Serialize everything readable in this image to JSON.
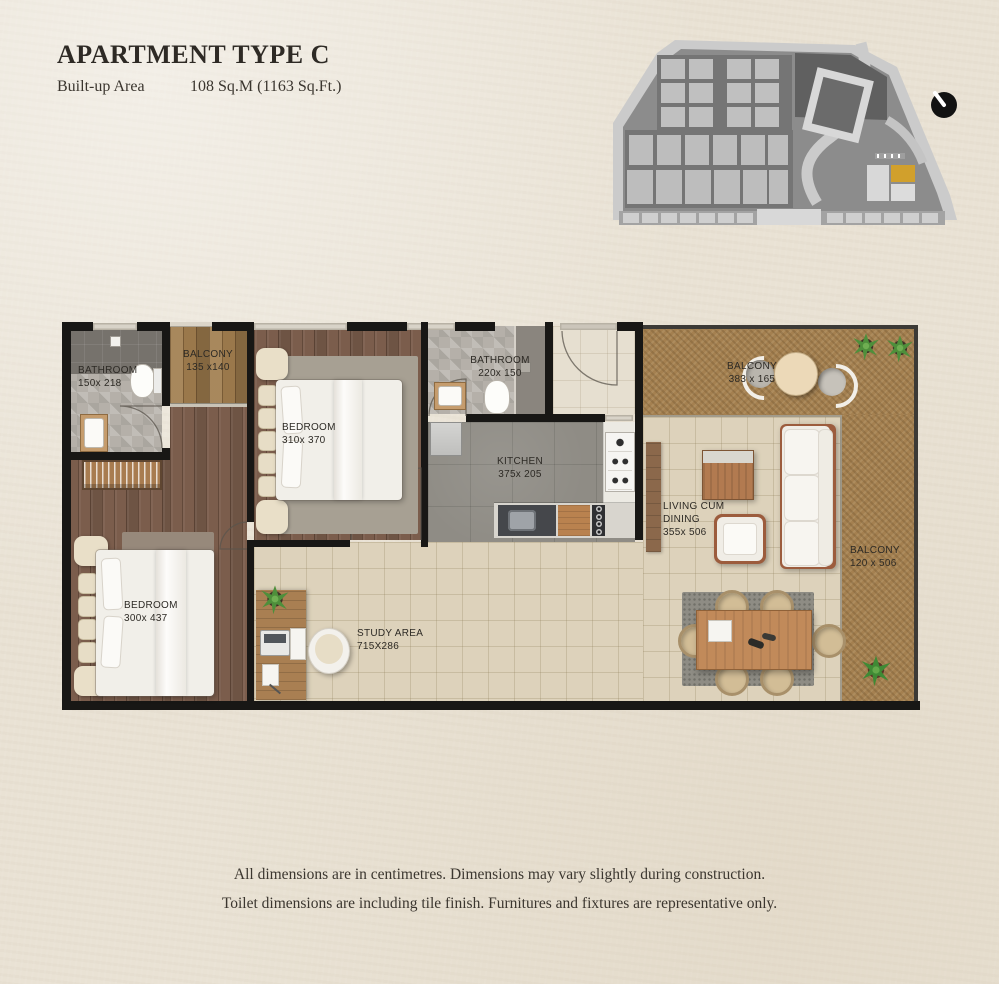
{
  "header": {
    "title": "APARTMENT TYPE C",
    "built_up_label": "Built-up Area",
    "built_up_value": "108 Sq.M (1163 Sq.Ft.)"
  },
  "rooms": {
    "bathroom1": {
      "name": "BATHROOM",
      "dims": "150x 218"
    },
    "balcony1": {
      "name": "BALCONY",
      "dims": "135 x140"
    },
    "bedroom1": {
      "name": "BEDROOM",
      "dims": "310x 370"
    },
    "bathroom2": {
      "name": "BATHROOM",
      "dims": "220x 150"
    },
    "kitchen": {
      "name": "KITCHEN",
      "dims": "375x 205"
    },
    "balcony_top": {
      "name": "BALCONY",
      "dims": "383 x 165"
    },
    "living": {
      "name1": "LIVING CUM",
      "name2": "DINING",
      "dims": "355x 506"
    },
    "balcony_right": {
      "name": "BALCONY",
      "dims": "120 x 506"
    },
    "bedroom2": {
      "name": "BEDROOM",
      "dims": "300x 437"
    },
    "study": {
      "name": "STUDY AREA",
      "dims": "715X286"
    }
  },
  "footer": {
    "line1": "All dimensions are in centimetres. Dimensions may vary slightly during construction.",
    "line2": "Toilet dimensions are including tile finish. Furnitures and fixtures are representative only."
  },
  "colors": {
    "background": "#e9e2d4",
    "wall": "#181715",
    "wood_floor": "#7b5d4c",
    "tile_floor": "#ddd2bb",
    "balcony_floor": "#a48050",
    "site_highlight": "#d1a02c"
  }
}
